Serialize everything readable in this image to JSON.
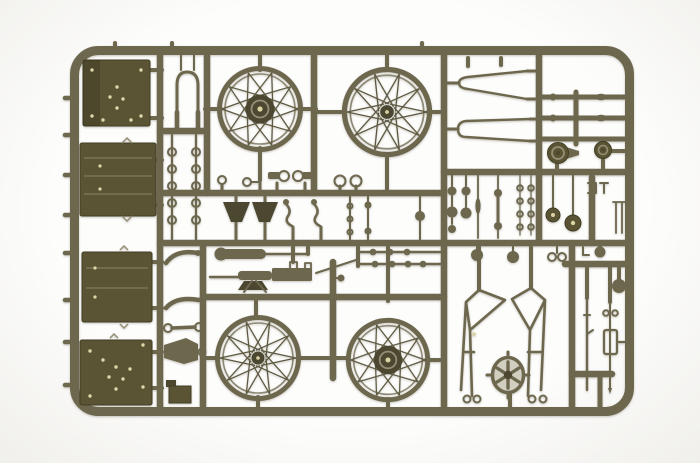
{
  "meta": {
    "alt": "Photograph of an olive drab injection-molded plastic model kit sprue on a white background, holding unassembled military motorcycle and sidecar parts: four wire-spoked wheels, riveted box panels, a front fork, exhaust pipes, a machine gun, sidecar chassis frames and many small fittings"
  },
  "colors": {
    "bg": "#fdfdfc",
    "vignette": "#f0efeb",
    "plastic": "#6d674e",
    "plastic_light": "#958f75",
    "plastic_dark": "#4c4731",
    "panel": "#5a5434",
    "panel_light": "#7b7557",
    "panel_edge": "#423e24",
    "rivet": "#ddd7ab",
    "spoke": "#5e5941",
    "hub_center": "#d9d2a2",
    "fan_bg": "#d2cfc1"
  },
  "parts": {
    "sprue": "olive drab plastic parts sprue",
    "frame": "sprue outer frame with gate stubs",
    "runners": "internal runner bars",
    "box_panels": "riveted and ribbed box panels",
    "front_fork": "front fork",
    "eyelets": "rack of small eyelet rings",
    "wheel_front_drum": "spoked wheel with brake drum hub",
    "wheel_front_plain": "spoked wheel with small hub",
    "wheel_rear_plain": "spoked wheel with small hub",
    "wheel_rear_drum": "spoked wheel with brake drum hub",
    "tank_halves": "elongated shell halves",
    "exhaust_rods": "exhaust pipe sections",
    "brake_drums": "brake drum housings",
    "mid_small_parts": "levers, rings and small controls",
    "seat_funnels": "tapered seat posts",
    "muffler": "muffler with exhaust pipe",
    "machine_gun": "machine gun",
    "link_rods": "linkage rods with small rings",
    "right_small_parts": "assorted small fittings",
    "fender_parts": "curved fender and bracket pieces",
    "sidecar_frame_left": "sidecar chassis frame, left",
    "sidecar_frame_right": "sidecar chassis frame, right",
    "fan_wheel": "finned hub wheel",
    "rifle": "rifle",
    "rod_assembly": "thin rod assembly"
  }
}
